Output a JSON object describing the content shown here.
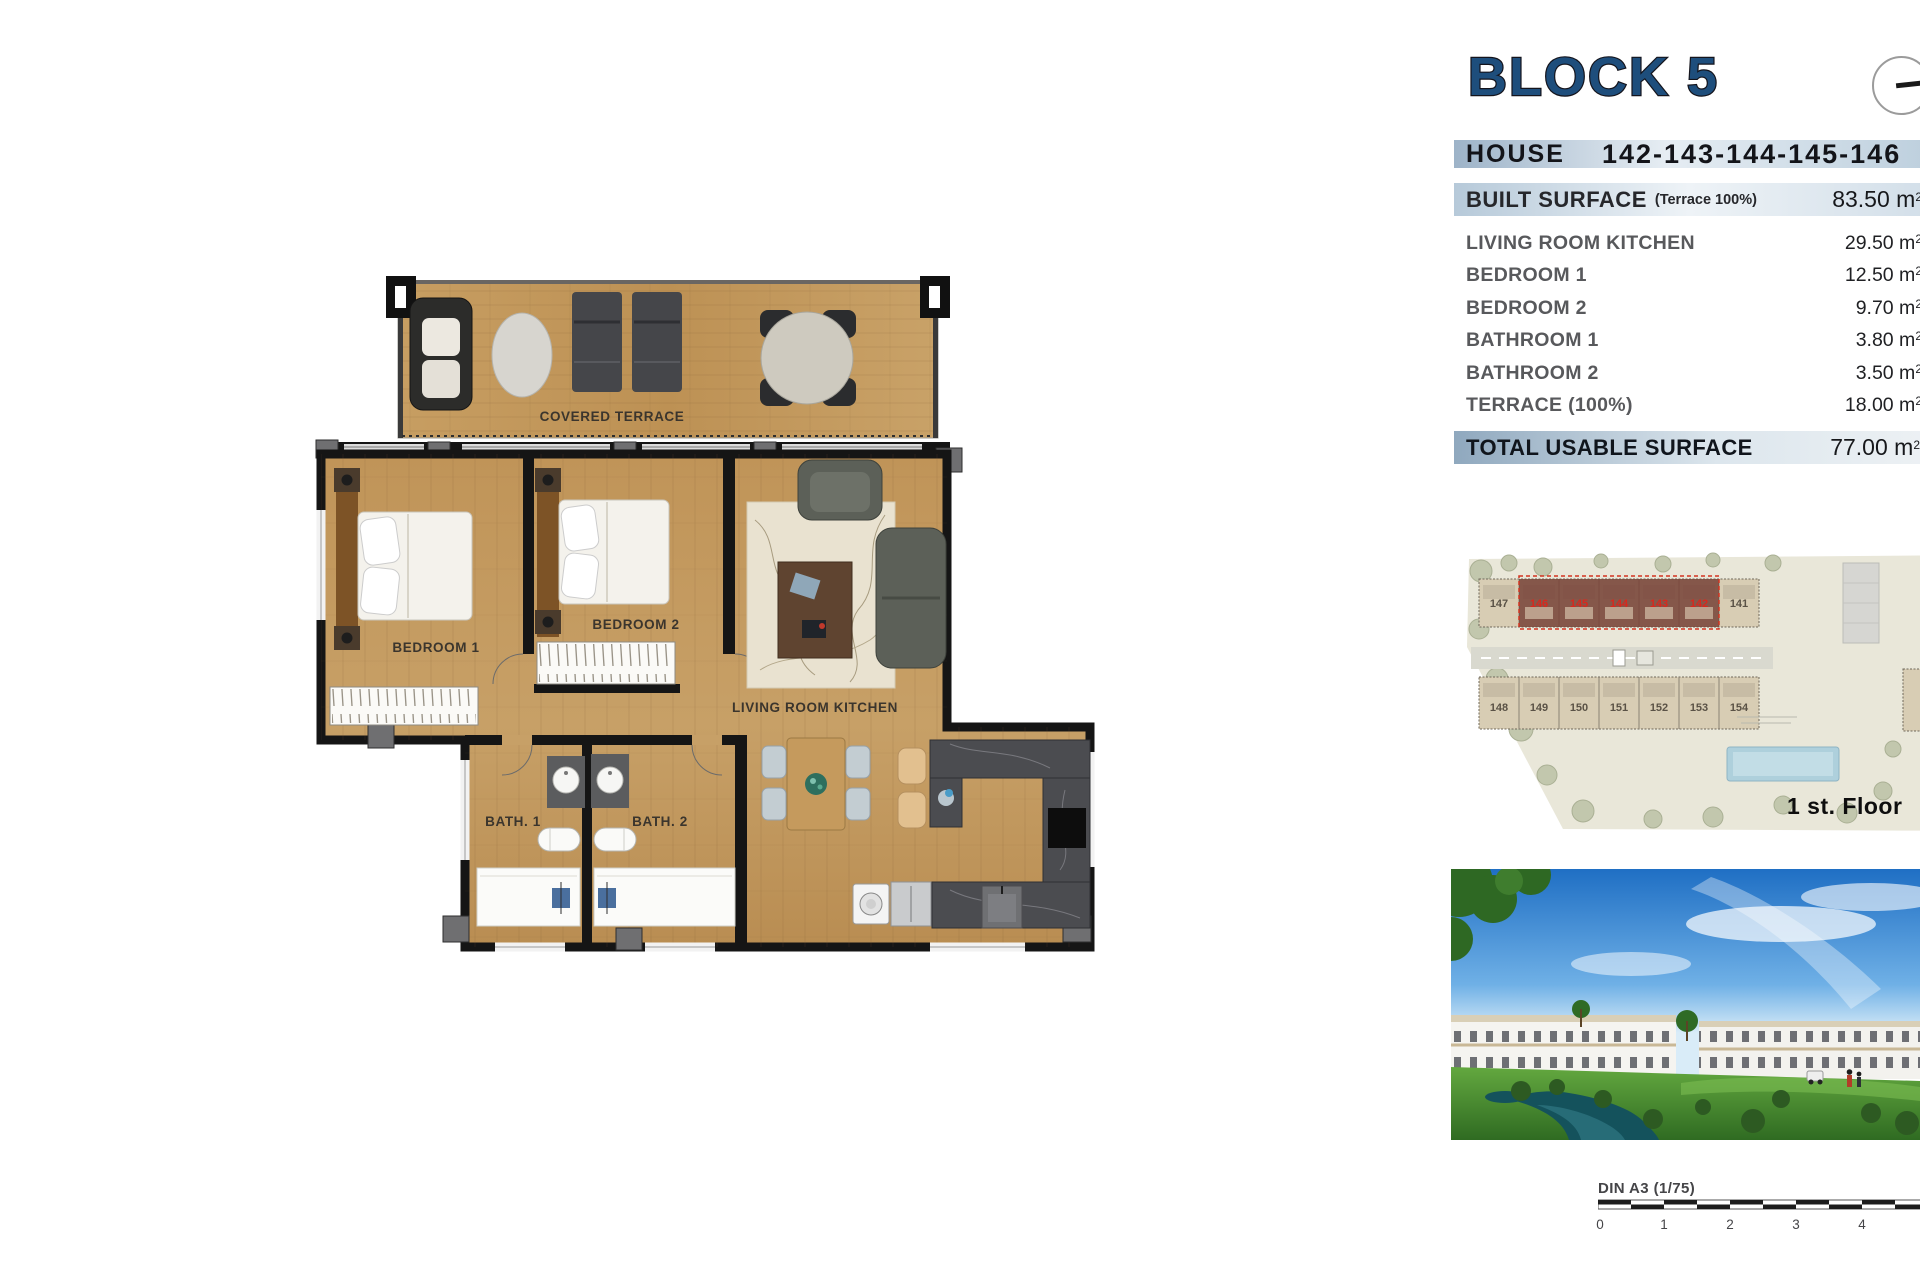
{
  "header": {
    "block_title": "BLOCK 5"
  },
  "house": {
    "label": "HOUSE",
    "numbers": "142-143-144-145-146"
  },
  "built": {
    "label": "BUILT SURFACE",
    "note": "(Terrace 100%)",
    "value": "83.50 m"
  },
  "units": {
    "sup": "2"
  },
  "rooms": [
    {
      "label": "LIVING ROOM KITCHEN",
      "value": "29.50 m"
    },
    {
      "label": "BEDROOM 1",
      "value": "12.50 m"
    },
    {
      "label": "BEDROOM 2",
      "value": "9.70 m"
    },
    {
      "label": "BATHROOM 1",
      "value": "3.80 m"
    },
    {
      "label": "BATHROOM 2",
      "value": "3.50 m"
    },
    {
      "label": "TERRACE (100%)",
      "value": "18.00 m"
    }
  ],
  "total": {
    "label": "TOTAL USABLE SURFACE",
    "value": "77.00 m"
  },
  "plan": {
    "covered_terrace": "COVERED TERRACE",
    "bedroom1": "BEDROOM 1",
    "bedroom2": "BEDROOM 2",
    "living": "LIVING ROOM KITCHEN",
    "bath1": "BATH. 1",
    "bath2": "BATH. 2"
  },
  "site": {
    "floor_label": "1 st. Floor",
    "top_units": [
      "147",
      "146",
      "145",
      "144",
      "143",
      "142",
      "141"
    ],
    "bottom_units": [
      "148",
      "149",
      "150",
      "151",
      "152",
      "153",
      "154"
    ]
  },
  "scale": {
    "label": "DIN A3 (1/75)",
    "ticks": [
      "0",
      "1",
      "2",
      "3",
      "4"
    ]
  },
  "colors": {
    "title_blue": "#1e4e7c",
    "bar_blue": "#9db3c8",
    "wood": "#c49b60",
    "wall_black": "#151515",
    "highlight_red": "#d8281e",
    "site_land": "#e9e7d9",
    "river_teal": "#14525c"
  }
}
